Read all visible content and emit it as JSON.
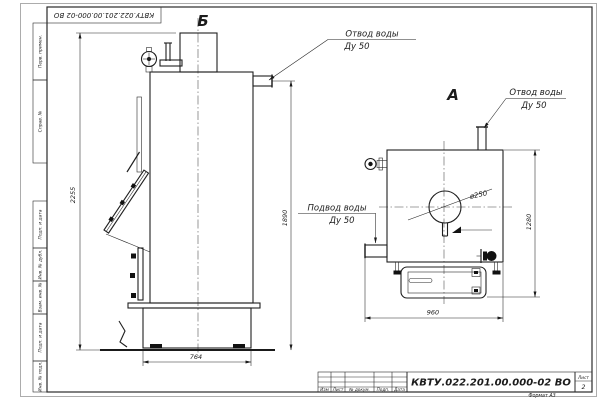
{
  "frame": {
    "doc_number_top": "КВТУ.022.201.00.000-02 ВО",
    "margin_stamps": [
      "Перв. примен.",
      "Справ. №",
      "Подп. и дата",
      "Инв. № дубл.",
      "Взам. инв. №",
      "Подп. и дата",
      "Инв. № подл."
    ]
  },
  "title_block": {
    "doc_number": "КВТУ.022.201.00.000-02 ВО",
    "columns": [
      "Изм",
      "Лист",
      "№ докум.",
      "Подп.",
      "Дата"
    ],
    "sheet_label": "Лист",
    "sheet_number": "2",
    "format": "Формат А3"
  },
  "views": {
    "front_label": "Б",
    "top_label": "А"
  },
  "labels": {
    "outlet_front": [
      "Отвод воды",
      "Ду 50"
    ],
    "outlet_top": [
      "Отвод воды",
      "Ду 50"
    ],
    "inlet": [
      "Подвод воды",
      "Ду 50"
    ],
    "chimney_diameter": "ø250"
  },
  "dimensions": {
    "overall_height": "2255",
    "outlet_height": "1890",
    "base_width": "764",
    "plan_width": "960",
    "plan_depth": "1280"
  }
}
